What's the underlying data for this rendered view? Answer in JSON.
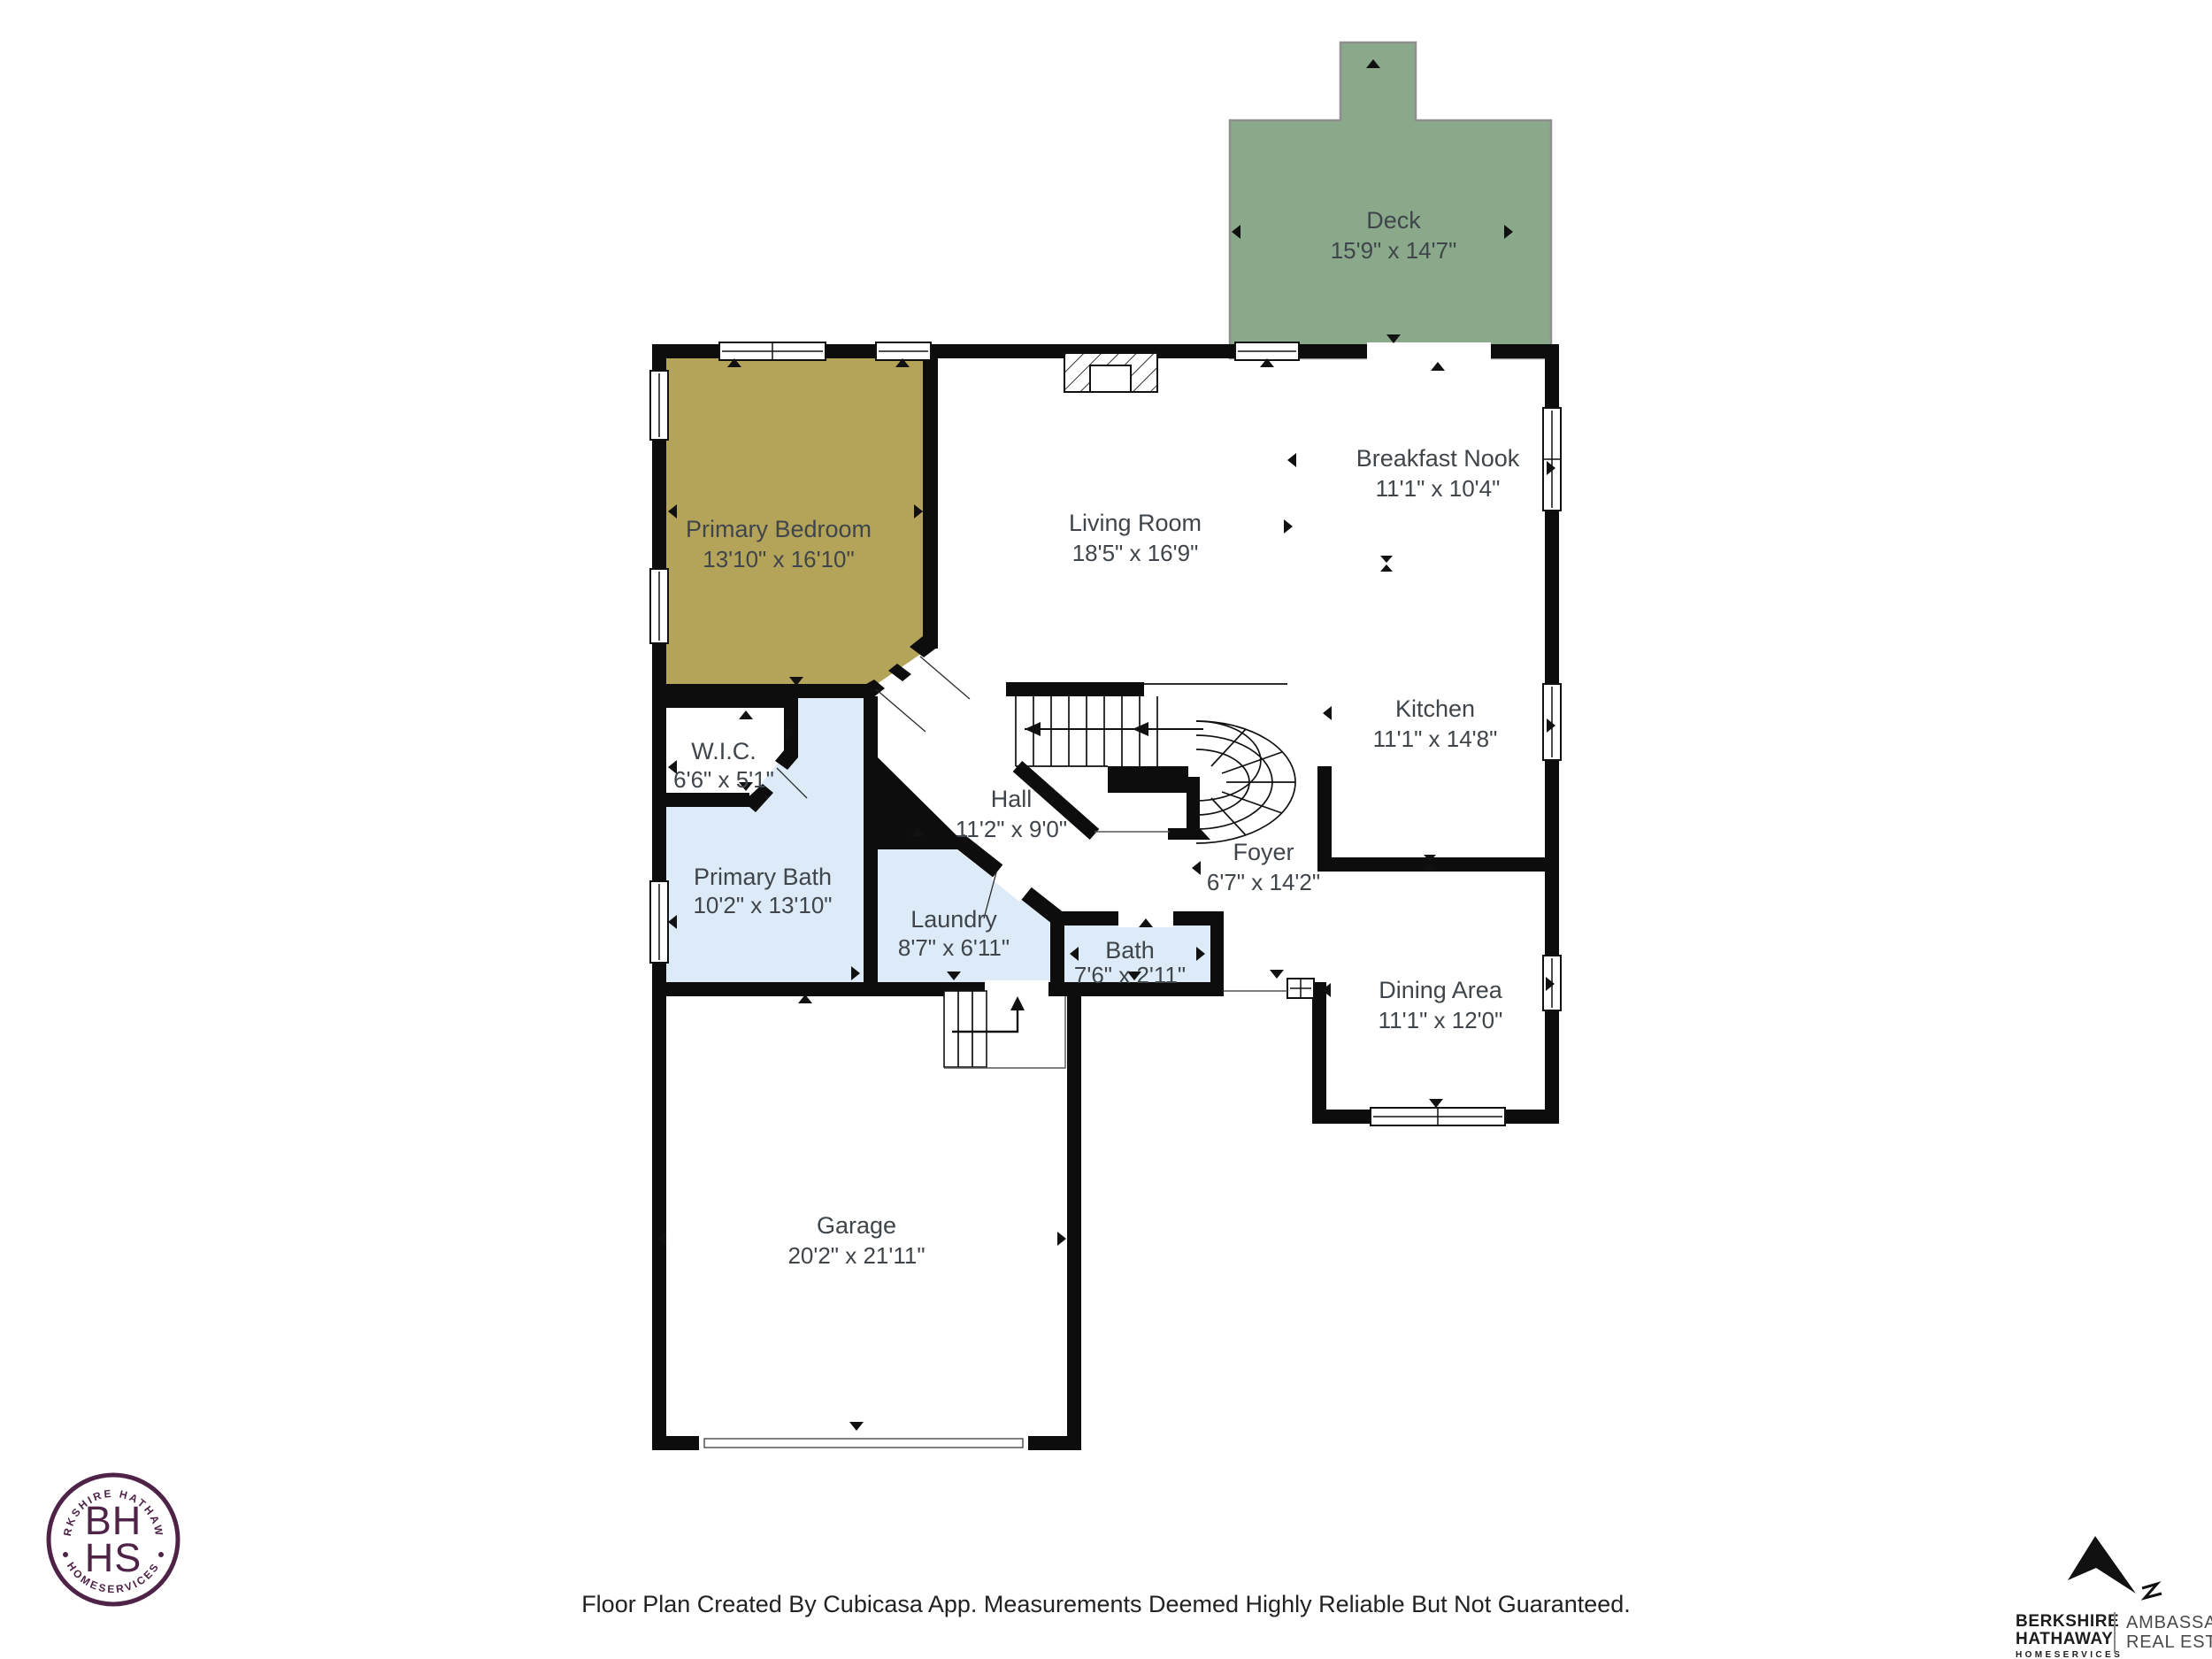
{
  "colors": {
    "wall": "#0d0d0d",
    "deck_fill": "#8aa98b",
    "deck_outline": "#8f8f8f",
    "bedroom_fill": "#b4a45a",
    "wet_room_fill": "#dcebf7",
    "room_fill_white": "#ffffff",
    "label_text": "#3f454a",
    "logo_plum": "#4e2347",
    "logo_black": "#1c1c1c",
    "logo_gray": "#4a4a4a",
    "background": "#ffffff"
  },
  "rooms": [
    {
      "id": "deck",
      "name": "Deck",
      "dims": "15'9\" x 14'7\""
    },
    {
      "id": "primary_bedroom",
      "name": "Primary Bedroom",
      "dims": "13'10\" x 16'10\""
    },
    {
      "id": "living_room",
      "name": "Living Room",
      "dims": "18'5\" x 16'9\""
    },
    {
      "id": "breakfast_nook",
      "name": "Breakfast Nook",
      "dims": "11'1\" x 10'4\""
    },
    {
      "id": "kitchen",
      "name": "Kitchen",
      "dims": "11'1\" x 14'8\""
    },
    {
      "id": "wic",
      "name": "W.I.C.",
      "dims": "6'6\" x 5'1\""
    },
    {
      "id": "primary_bath",
      "name": "Primary Bath",
      "dims": "10'2\" x 13'10\""
    },
    {
      "id": "hall",
      "name": "Hall",
      "dims": "11'2\" x 9'0\""
    },
    {
      "id": "foyer",
      "name": "Foyer",
      "dims": "6'7\" x 14'2\""
    },
    {
      "id": "laundry",
      "name": "Laundry",
      "dims": "8'7\" x 6'11\""
    },
    {
      "id": "bath",
      "name": "Bath",
      "dims": "7'6\" x 2'11\""
    },
    {
      "id": "dining_area",
      "name": "Dining Area",
      "dims": "11'1\" x 12'0\""
    },
    {
      "id": "garage",
      "name": "Garage",
      "dims": "20'2\" x 21'11\""
    }
  ],
  "footer": {
    "disclaimer": "Floor Plan Created By Cubicasa App. Measurements Deemed Highly Reliable But Not Guaranteed."
  },
  "logos": {
    "bhhs_seal": {
      "arc_top": "BERKSHIRE HATHAWAY",
      "monogram_line1": "BH",
      "monogram_line2": "HS",
      "arc_bottom": "HOMESERVICES"
    },
    "brokerage": {
      "line1": "BERKSHIRE",
      "line2": "HATHAWAY",
      "line3": "HOMESERVICES",
      "division_line1": "AMBASSADOR",
      "division_line2": "REAL ESTATE"
    }
  }
}
